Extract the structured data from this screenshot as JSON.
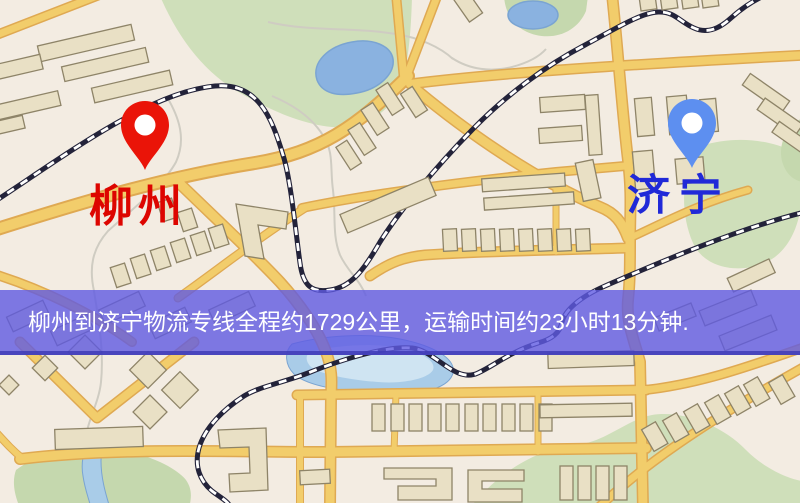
{
  "banner": {
    "text": "柳州到济宁物流专线全程约1729公里，运输时间约23小时13分钟."
  },
  "markers": {
    "origin": {
      "label": "柳州"
    },
    "destination": {
      "label": "济宁"
    }
  },
  "icons": {
    "origin_pin": "map-pin",
    "destination_pin": "map-pin"
  },
  "colors": {
    "bg": "#f3ece2",
    "park": "#cfdfba",
    "park_dark": "#c5d8ae",
    "water": "#8ab2e0",
    "water_light": "#a9cce8",
    "water_hl": "#cfe4f2",
    "water_stroke": "#7aa4d2",
    "road": "#f2cd6b",
    "road_casing": "#dfa952",
    "rail": "#23233a",
    "building": "#e9e0c5",
    "building_stroke": "#8e8468",
    "stream": "#cfccc2",
    "banner_bg": "rgba(95,90,226,0.80)",
    "banner_edge": "rgba(64,60,182,0.85)",
    "banner_text": "#ffffff",
    "origin_pin": "#ea1408",
    "origin_label": "#dd0500",
    "dest_pin": "#5d8ff0",
    "dest_label": "#2029d8"
  }
}
